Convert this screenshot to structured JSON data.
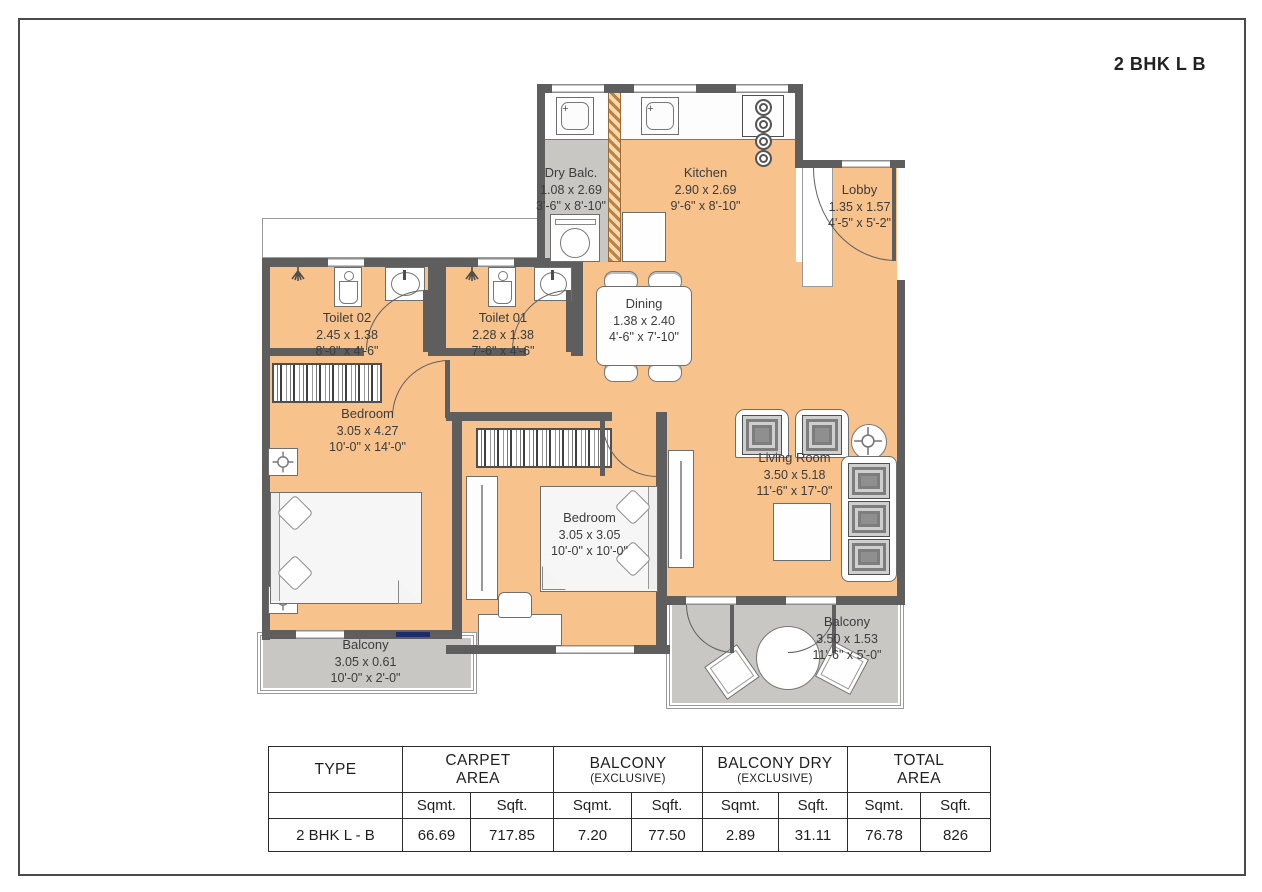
{
  "title": "2 BHK L B",
  "colors": {
    "floor": "#f7c28c",
    "wall": "#5e5e5e",
    "balcony_floor": "#c9c7c4",
    "frame_border": "#4a4a4a",
    "sliding_door": "#1d2d6b"
  },
  "icons": {
    "sink_plus": "+"
  },
  "rooms": [
    {
      "name": "Dry Balc.",
      "dim_m": "1.08 x 2.69",
      "dim_ft": "3'-6\" x 8'-10\""
    },
    {
      "name": "Kitchen",
      "dim_m": "2.90 x 2.69",
      "dim_ft": "9'-6\" x 8'-10\""
    },
    {
      "name": "Lobby",
      "dim_m": "1.35 x 1.57",
      "dim_ft": "4'-5\" x 5'-2\""
    },
    {
      "name": "Toilet 02",
      "dim_m": "2.45 x 1.38",
      "dim_ft": "8'-0\" x 4'-6\""
    },
    {
      "name": "Toilet 01",
      "dim_m": "2.28 x 1.38",
      "dim_ft": "7'-6\" x 4'-6\""
    },
    {
      "name": "Dining",
      "dim_m": "1.38 x 2.40",
      "dim_ft": "4'-6\" x 7'-10\""
    },
    {
      "name": "Bedroom",
      "dim_m": "3.05 x 4.27",
      "dim_ft": "10'-0\" x 14'-0\""
    },
    {
      "name": "Bedroom",
      "dim_m": "3.05 x 3.05",
      "dim_ft": "10'-0\" x 10'-0\""
    },
    {
      "name": "Living Room",
      "dim_m": "3.50 x 5.18",
      "dim_ft": "11'-6\" x 17'-0\""
    },
    {
      "name": "Balcony",
      "dim_m": "3.05 x 0.61",
      "dim_ft": "10'-0\" x 2'-0\""
    },
    {
      "name": "Balcony",
      "dim_m": "3.50 x 1.53",
      "dim_ft": "11'-6\" x 5'-0\""
    }
  ],
  "area_table": {
    "headers": {
      "type": "TYPE",
      "carpet_l1": "CARPET",
      "carpet_l2": "AREA",
      "balcony_l1": "BALCONY",
      "balcony_l2": "(EXCLUSIVE)",
      "balcony_dry_l1": "BALCONY DRY",
      "balcony_dry_l2": "(EXCLUSIVE)",
      "total_l1": "TOTAL",
      "total_l2": "AREA"
    },
    "units": [
      "Sqmt.",
      "Sqft.",
      "Sqmt.",
      "Sqft.",
      "Sqmt.",
      "Sqft.",
      "Sqmt.",
      "Sqft."
    ],
    "row_label": "2 BHK L - B",
    "values": [
      "66.69",
      "717.85",
      "7.20",
      "77.50",
      "2.89",
      "31.11",
      "76.78",
      "826"
    ]
  }
}
